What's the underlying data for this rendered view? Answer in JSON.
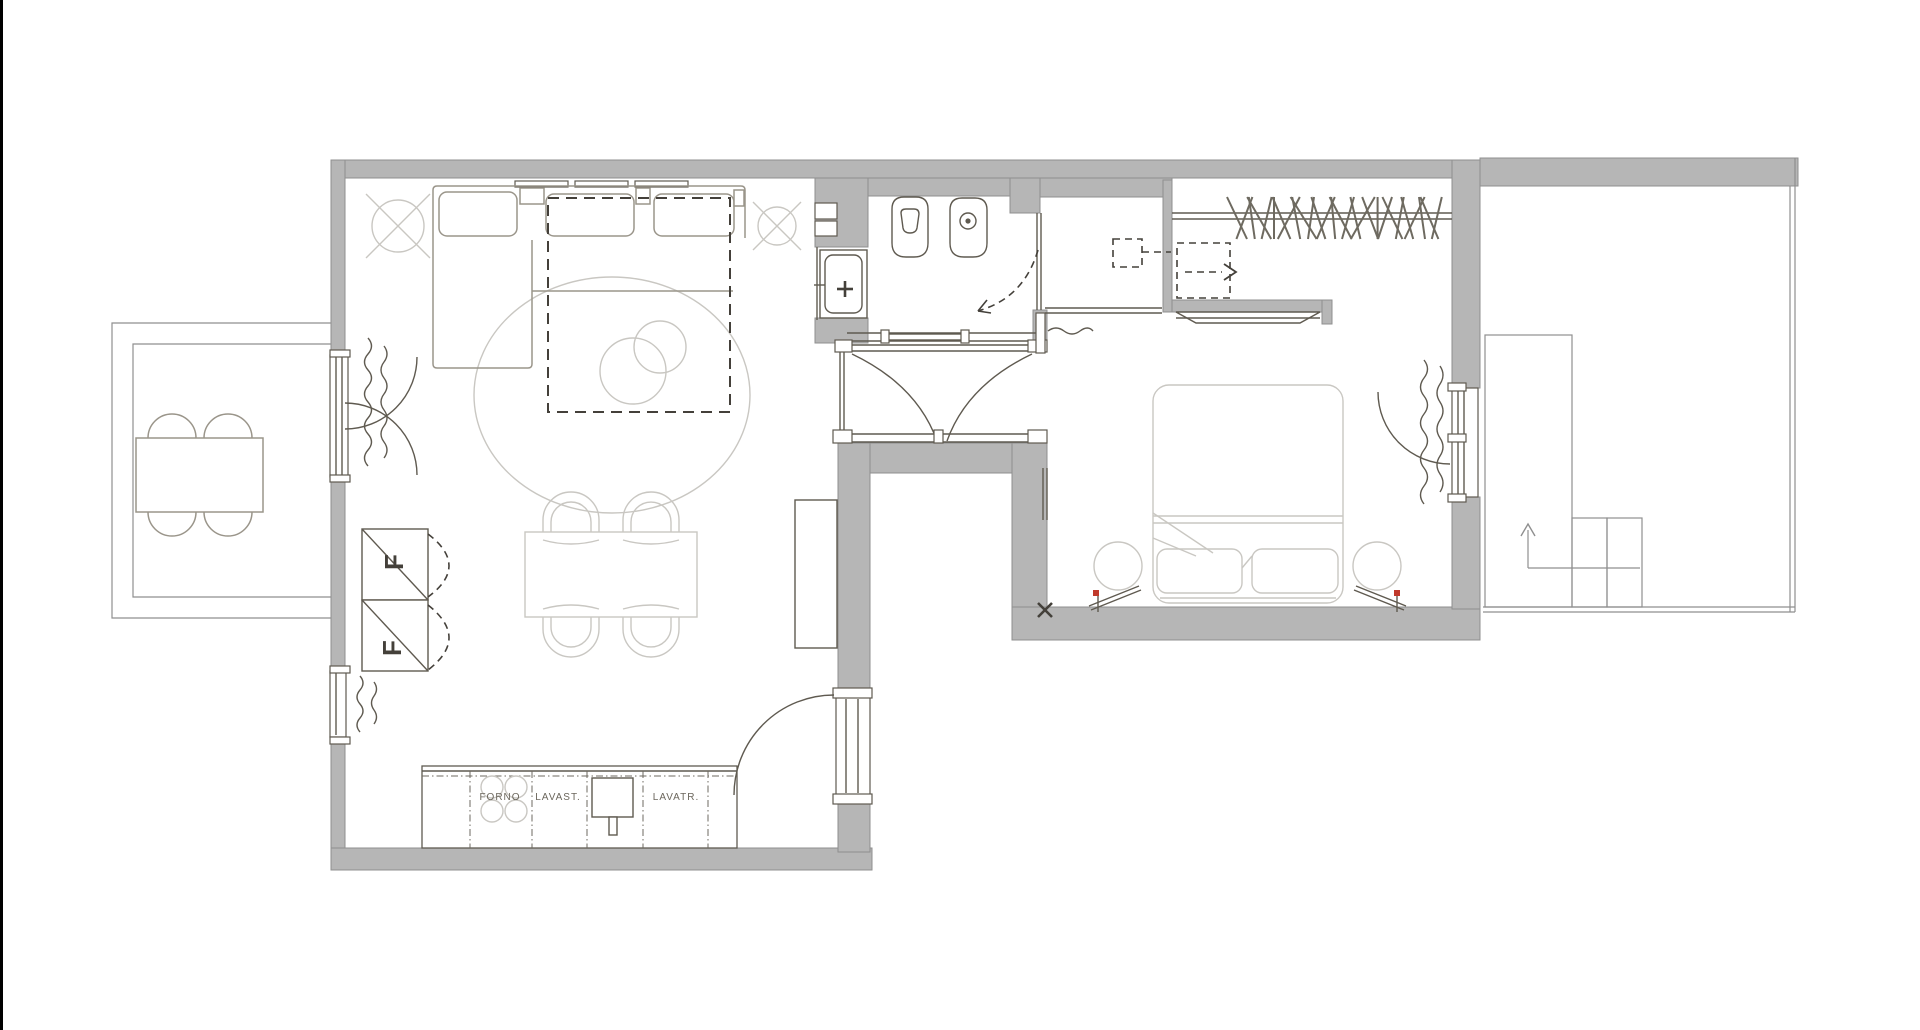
{
  "plan_title": "apartment-floor-plan",
  "labels": {
    "forno": "FORNO",
    "lavastoviglie": "LAVAST.",
    "lavatrice": "LAVATR.",
    "storage_column_upper": "F",
    "storage_column_lower": "F",
    "corner_mark": "x"
  },
  "rooms": [
    {
      "name": "balcony-left"
    },
    {
      "name": "living-room"
    },
    {
      "name": "kitchen-area"
    },
    {
      "name": "bathroom"
    },
    {
      "name": "hallway-vestibule"
    },
    {
      "name": "laundry-niche"
    },
    {
      "name": "walk-in-closet"
    },
    {
      "name": "bedroom"
    },
    {
      "name": "balcony-right"
    }
  ],
  "colors": {
    "background": "#ffffff",
    "wall_fill": "#b6b6b6",
    "wall_edge": "#8f8f8f",
    "fixture_line": "#5f5a50",
    "furniture_light": "#c9c7c2",
    "furniture_mid": "#9a958a",
    "dashed_line": "#44403a",
    "accent_red": "#c0392b",
    "edge_bar": "#000000"
  }
}
